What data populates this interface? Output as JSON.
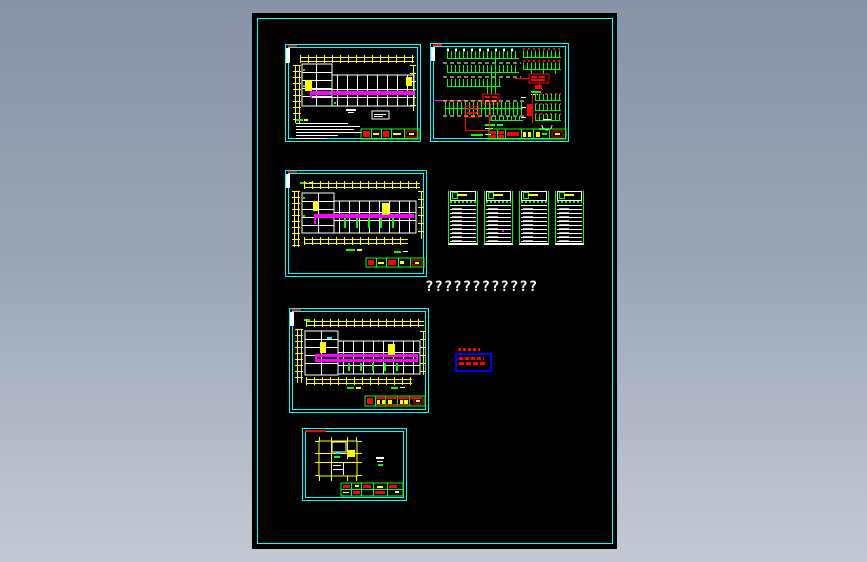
{
  "window": {
    "kind": "cad-drawing-preview",
    "background_gradient_top": "#8793a6",
    "background_gradient_bottom": "#c4cad4",
    "canvas_color": "#000000",
    "canvas_frame_color": "#00ffff"
  },
  "palette": {
    "cyan": "#00ffff",
    "yellow": "#ffff00",
    "magenta": "#ff00ff",
    "red": "#ff0000",
    "green": "#00ff00",
    "white": "#ffffff",
    "blue": "#0000ff",
    "black": "#000000"
  },
  "placeholder": {
    "text": "????????????"
  },
  "sheets": [
    {
      "name": "floor-plan-top-left",
      "kind": "building floor plan with magenta busway, yellow dimension lines, notes and title block"
    },
    {
      "name": "distribution-system-diagram",
      "kind": "electrical distribution system schematic with green circuit combs and red panel boxes"
    },
    {
      "name": "floor-plan-middle-left",
      "kind": "building floor plan with magenta busway and title block"
    },
    {
      "name": "floor-plan-bottom-left",
      "kind": "building floor plan with double magenta busway and title block"
    },
    {
      "name": "small-roof-plan",
      "kind": "small yellow plan with title strip"
    }
  ],
  "panel_schedules": {
    "count": 4,
    "row_count": 9
  },
  "legend_note": {
    "note_lines": 2,
    "border_color": "#0000ff",
    "text_color": "#ff0000"
  }
}
